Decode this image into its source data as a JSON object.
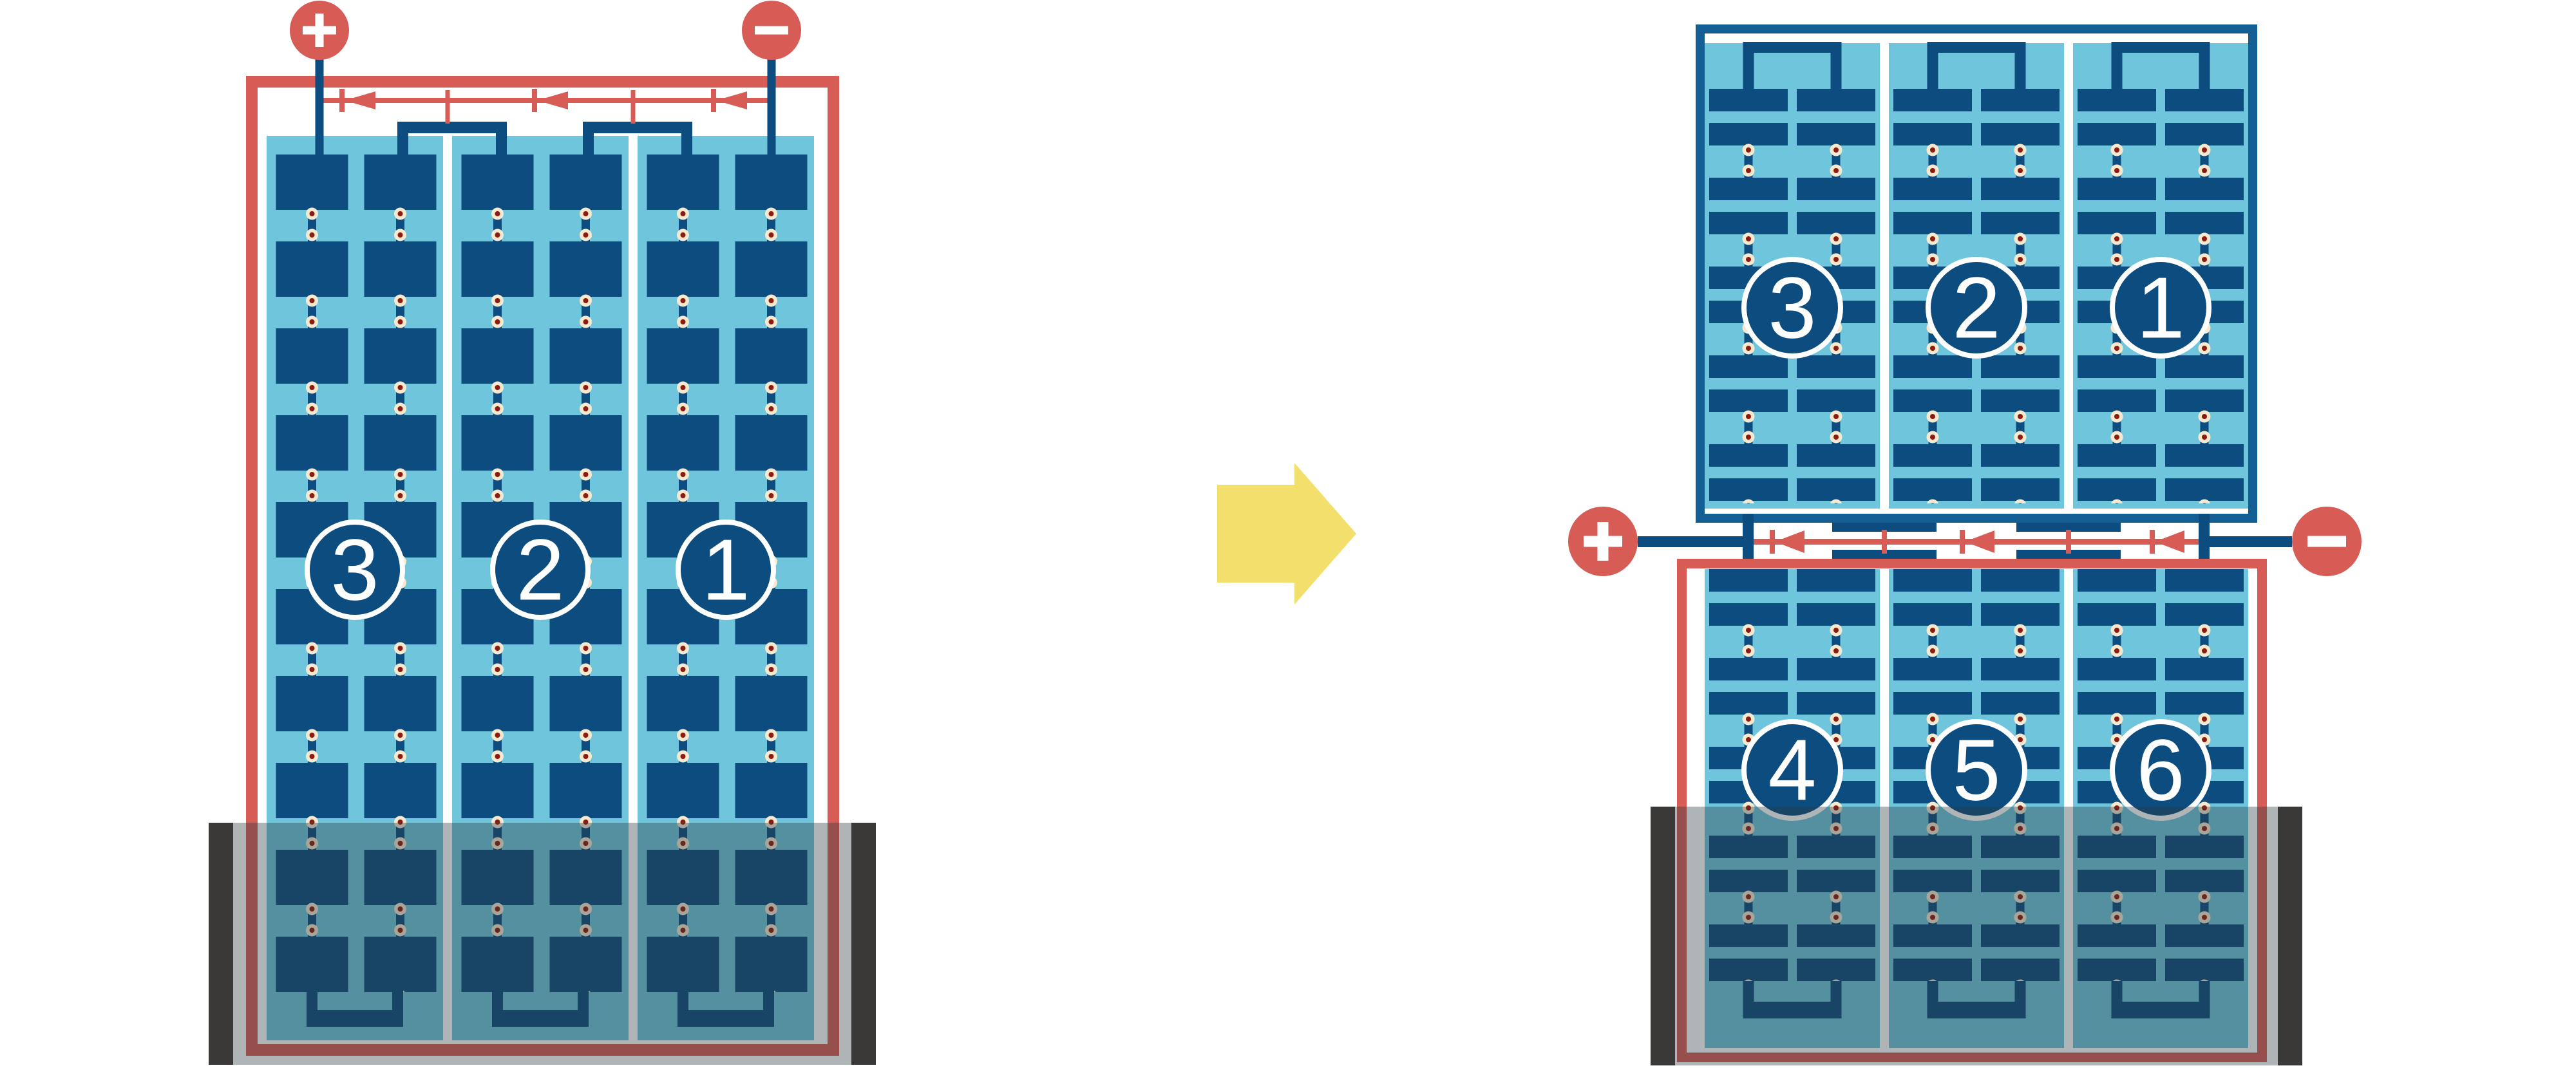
{
  "left_module": {
    "terminal_positive": "+",
    "terminal_negative": "−",
    "strings": [
      "3",
      "2",
      "1"
    ],
    "bypass_diode_count": 3,
    "shaded_region": "bottom"
  },
  "right_modules": {
    "terminal_positive": "+",
    "terminal_negative": "−",
    "top_module_strings": [
      "3",
      "2",
      "1"
    ],
    "bottom_module_strings": [
      "4",
      "5",
      "6"
    ],
    "bypass_diode_count": 3,
    "shaded_region": "bottom"
  },
  "arrow": {
    "direction": "right"
  },
  "colors": {
    "red": "#d75c55",
    "cell_navy": "#0c4c7e",
    "frame_navy": "#135e93",
    "light_blue": "#6fc5dc",
    "connector_cream": "#f6e9d0",
    "connector_dot_red": "#8e1a10",
    "arrow_yellow": "#f2df6c",
    "shade_post_dark": "#3a3937",
    "background": "#ffffff"
  }
}
